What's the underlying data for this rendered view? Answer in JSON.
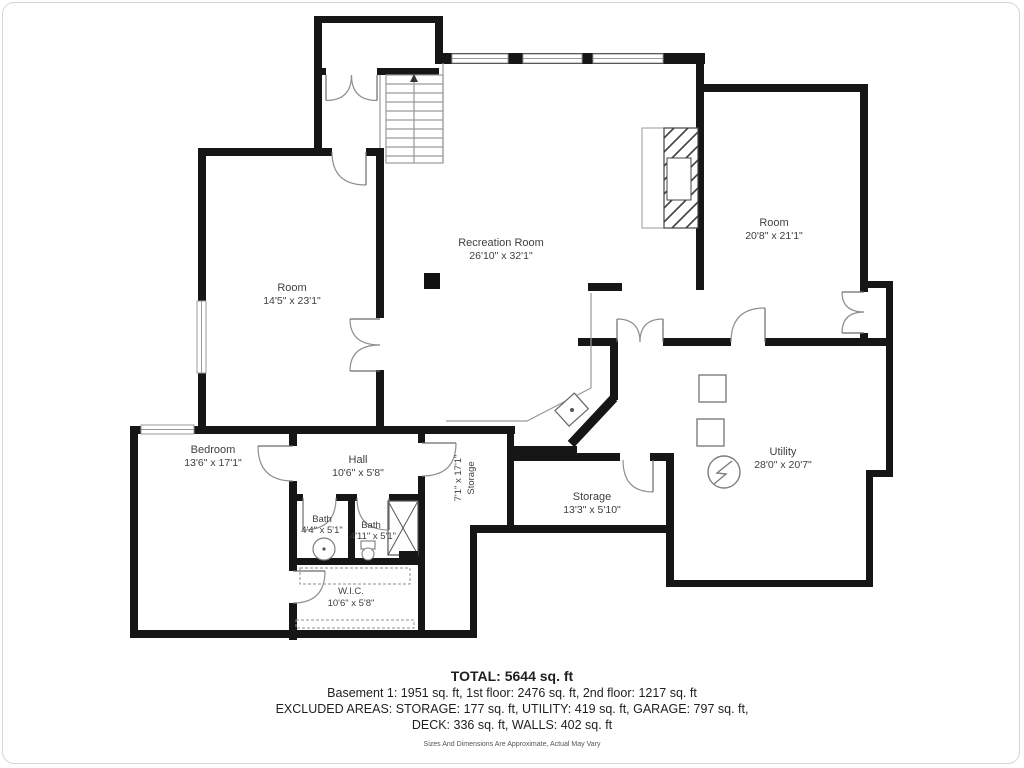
{
  "rooms": {
    "recreation_room": {
      "name": "Recreation Room",
      "dims": "26'10\" x 32'1\""
    },
    "room_upper_right": {
      "name": "Room",
      "dims": "20'8\" x 21'1\""
    },
    "room_upper_left": {
      "name": "Room",
      "dims": "14'5\" x 23'1\""
    },
    "hall": {
      "name": "Hall",
      "dims": "10'6\" x 5'8\""
    },
    "storage_corridor": {
      "name": "Storage",
      "dims": "7'1\" x 17'1\""
    },
    "storage": {
      "name": "Storage",
      "dims": "13'3\" x 5'10\""
    },
    "utility": {
      "name": "Utility",
      "dims": "28'0\" x 20'7\""
    },
    "bedroom": {
      "name": "Bedroom",
      "dims": "13'6\" x 17'1\""
    },
    "bath_1": {
      "name": "Bath",
      "dims": "4'4\" x 5'1\""
    },
    "bath_2": {
      "name": "Bath",
      "dims": "4'11\" x 5'1\""
    },
    "wic": {
      "name": "W.I.C.",
      "dims": "10'6\" x 5'8\""
    }
  },
  "summary": {
    "total": "TOTAL: 5644 sq. ft",
    "floors": "Basement 1: 1951 sq. ft, 1st floor: 2476 sq. ft, 2nd floor: 1217 sq. ft",
    "excluded_1": "EXCLUDED AREAS: STORAGE: 177 sq. ft, UTILITY: 419 sq. ft, GARAGE: 797 sq. ft,",
    "excluded_2": "DECK: 336 sq. ft, WALLS: 402 sq. ft",
    "disclaimer": "Sizes And Dimensions Are Approximate, Actual May Vary"
  },
  "symbols": {
    "staircase": "parallel-tread-lines",
    "fireplace": "diagonal-hatch-rect",
    "electrical_panel": "circle-lightning-bolt",
    "utility_equipment": "outline-squares",
    "kitchen_sink": "angled-square-with-dot",
    "toilet": "ellipse-with-tank",
    "pedestal_sink": "circle-with-dot",
    "shower": "x-crossed-box",
    "closet_rod": "dashed-rect",
    "window": "double-line-band",
    "door": "quarter-arc-swing"
  },
  "colors": {
    "wall": "#161616",
    "label": "#3f3f3f",
    "door_arc": "#8f8f8f",
    "fixture": "#7d7d7d",
    "window_line": "#9a9a9a",
    "frame_border": "#d5d5d5"
  }
}
